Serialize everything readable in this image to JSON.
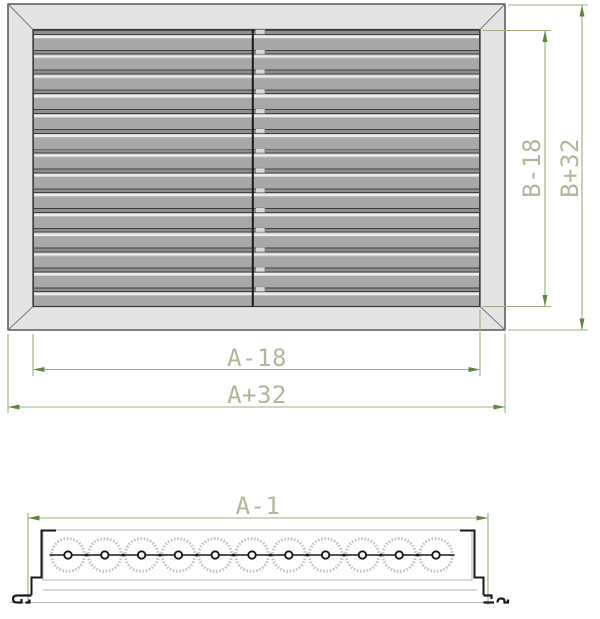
{
  "view_front": {
    "dim_width_inner": "A-18",
    "dim_width_outer": "A+32",
    "dim_height_inner": "B-18",
    "dim_height_outer": "B+32",
    "louver_clip_count": 14
  },
  "view_section": {
    "dim_width": "A-1",
    "spring_count": 11
  },
  "colors": {
    "dim_line": "#9cb082",
    "dim_arrow": "#5f8444",
    "dim_text": "#aeb99a",
    "frame_fill": "#e4e4e4",
    "outline": "#3a3a3a",
    "miter_line": "#7a7a7a",
    "profile": "#1a1a1a",
    "panel_line": "#b4b4b4",
    "spring_stroke": "#c6c6c6",
    "clip_fill": "#d9d9d9"
  }
}
